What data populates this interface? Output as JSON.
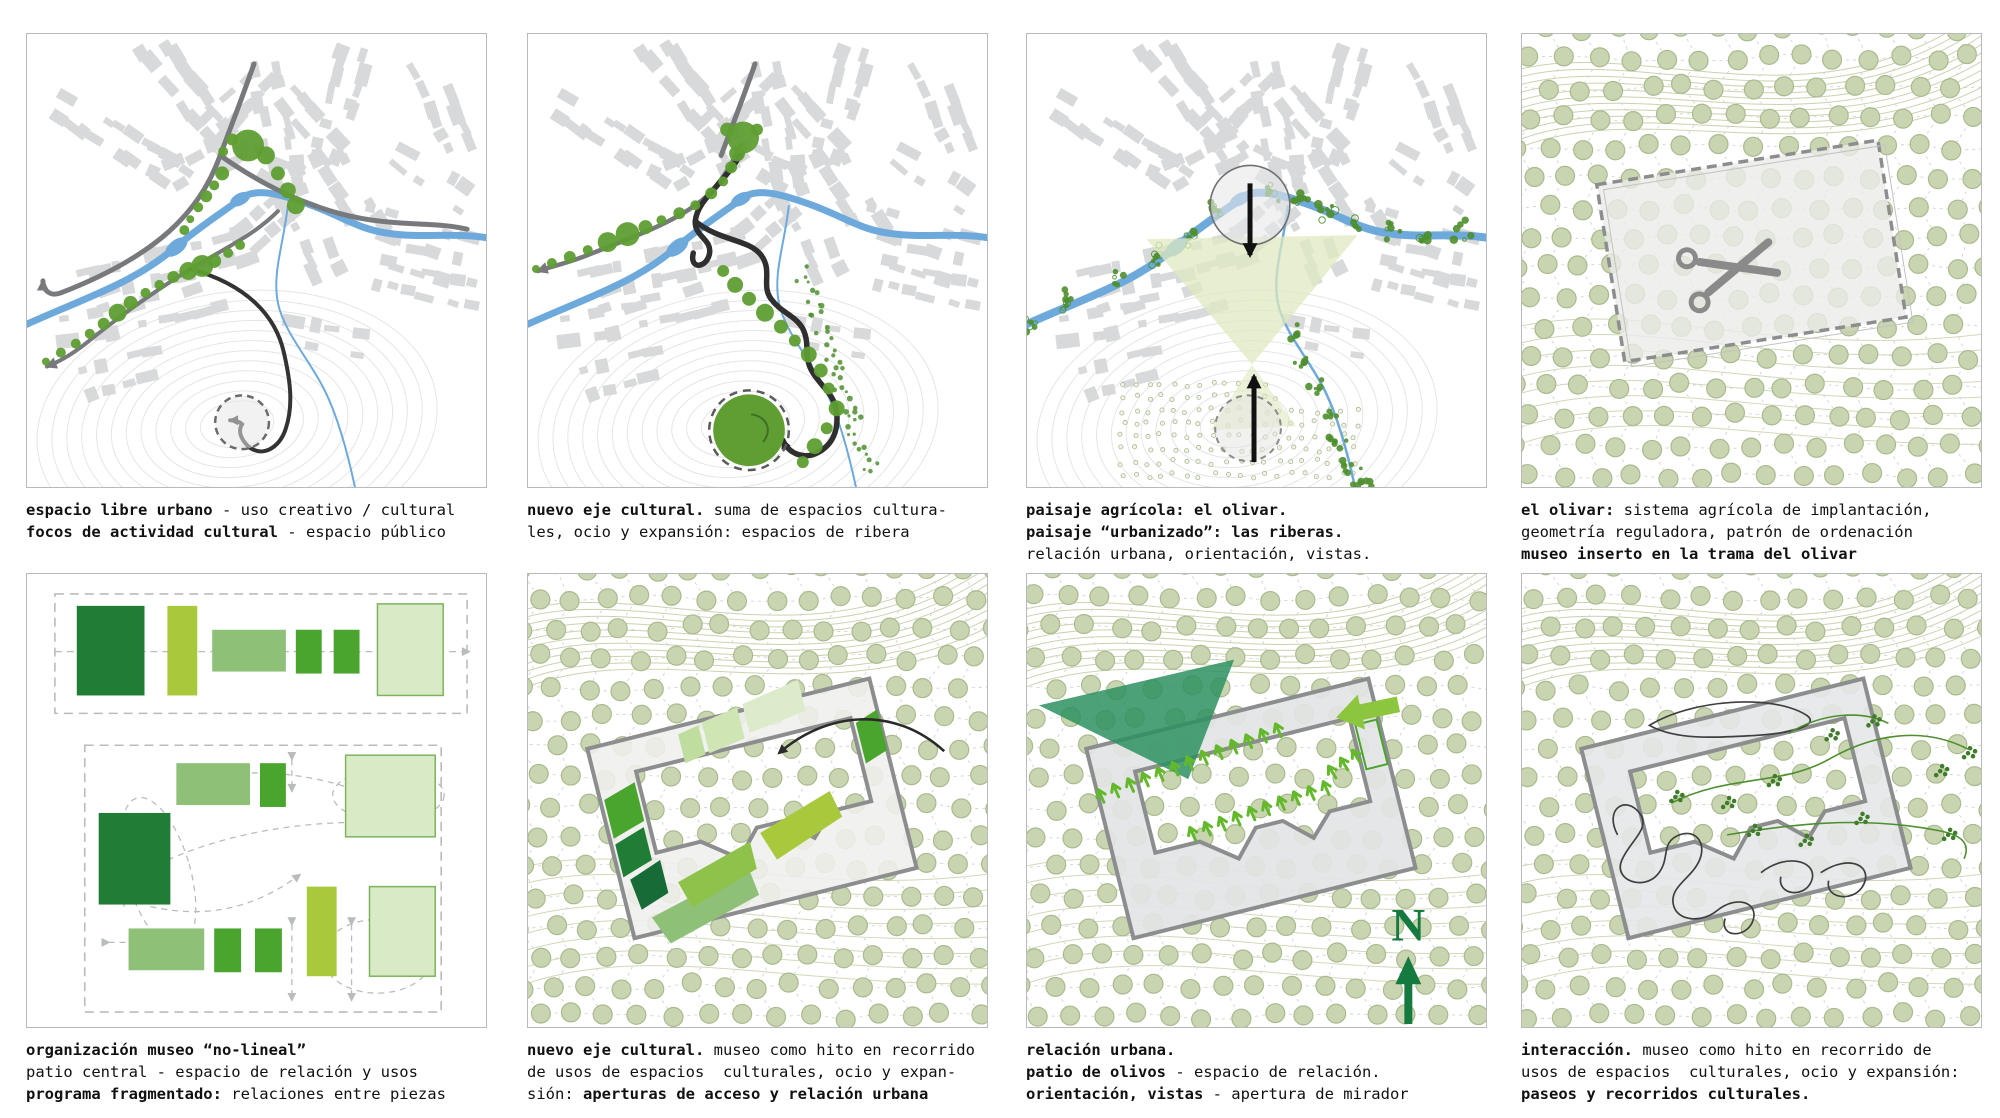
{
  "sheet_background": "#ffffff",
  "colors": {
    "building_gray": "#d7d9da",
    "road_gray": "#77797c",
    "river_blue": "#6ea9dc",
    "dot_green": "#5f9e32",
    "tree_green": "#4e8f2e",
    "olive_fill": "#c9d5b0",
    "olive_stroke": "#a9ba8e",
    "contour_olive": "#b9c394",
    "contour_gray": "#e4e5e5",
    "lattice_gray": "#d2d2d2",
    "site_gray": "#8b8d8e",
    "site_fill": "#ebebe9",
    "ink_black": "#2b2b2b",
    "view_triangle_dark": "#2d9160",
    "view_wedge_pale": "#dfe9c0",
    "arrow_small_green": "#63b92b",
    "arrow_big_green": "#8cc63f",
    "north_green": "#157a40",
    "museum_dark": "#1f7d36",
    "museum_lime": "#a9c93d",
    "museum_mid": "#8fc077",
    "museum_bright": "#4aa52e",
    "museum_pale": "#d9eac6",
    "museum_pale_stroke": "#7cb45c",
    "caption_ink": "#111111",
    "panel_border": "#b6babb",
    "dash_gray": "#b9bcbd"
  },
  "panels": [
    {
      "name": "espacio-libre-urbano",
      "caption": [
        [
          {
            "t": "espacio libre urbano",
            "b": 1
          },
          {
            "t": " - uso creativo / cultural",
            "b": 0
          }
        ],
        [
          {
            "t": "focos de actividad cultural",
            "b": 1
          },
          {
            "t": " - espacio público",
            "b": 0
          }
        ]
      ]
    },
    {
      "name": "nuevo-eje-cultural-urbano",
      "caption": [
        [
          {
            "t": "nuevo eje cultural.",
            "b": 1
          },
          {
            "t": " suma de espacios cultura-",
            "b": 0
          }
        ],
        [
          {
            "t": "les, ocio y expansión: espacios de ribera",
            "b": 0
          }
        ]
      ]
    },
    {
      "name": "paisaje-agricola",
      "caption": [
        [
          {
            "t": "paisaje agrícola: el olivar.",
            "b": 1
          }
        ],
        [
          {
            "t": "paisaje “urbanizado”: las riberas.",
            "b": 1
          }
        ],
        [
          {
            "t": "relación urbana, orientación, vistas.",
            "b": 0
          }
        ]
      ]
    },
    {
      "name": "el-olivar",
      "caption": [
        [
          {
            "t": "el olivar:",
            "b": 1
          },
          {
            "t": " sistema agrícola de implantación,",
            "b": 0
          }
        ],
        [
          {
            "t": "geometría reguladora, patrón de ordenación",
            "b": 0
          }
        ],
        [
          {
            "t": "museo inserto en la trama del olivar",
            "b": 1
          }
        ]
      ]
    },
    {
      "name": "organizacion-museo",
      "caption": [
        [
          {
            "t": "organización museo “no-lineal”",
            "b": 1
          }
        ],
        [
          {
            "t": "patio central - espacio de relación y usos",
            "b": 0
          }
        ],
        [
          {
            "t": "programa fragmentado:",
            "b": 1
          },
          {
            "t": " relaciones entre piezas",
            "b": 0
          }
        ]
      ]
    },
    {
      "name": "nuevo-eje-cultural-museo",
      "caption": [
        [
          {
            "t": "nuevo eje cultural.",
            "b": 1
          },
          {
            "t": " museo como hito en recorrido",
            "b": 0
          }
        ],
        [
          {
            "t": "de usos de espacios  culturales, ocio y expan-",
            "b": 0
          }
        ],
        [
          {
            "t": "sión: ",
            "b": 0
          },
          {
            "t": "aperturas de acceso y relación urbana",
            "b": 1
          }
        ]
      ]
    },
    {
      "name": "relacion-urbana",
      "north_label": "N",
      "caption": [
        [
          {
            "t": "relación urbana.",
            "b": 1
          }
        ],
        [
          {
            "t": "patio de olivos",
            "b": 1
          },
          {
            "t": " - espacio de relación.",
            "b": 0
          }
        ],
        [
          {
            "t": "orientación, vistas",
            "b": 1
          },
          {
            "t": " - apertura de mirador",
            "b": 0
          }
        ]
      ]
    },
    {
      "name": "interaccion",
      "caption": [
        [
          {
            "t": "interacción.",
            "b": 1
          },
          {
            "t": " museo como hito en recorrido de",
            "b": 0
          }
        ],
        [
          {
            "t": "usos de espacios  culturales, ocio y expansión:",
            "b": 0
          }
        ],
        [
          {
            "t": "paseos y recorridos culturales.",
            "b": 1
          }
        ]
      ]
    }
  ]
}
